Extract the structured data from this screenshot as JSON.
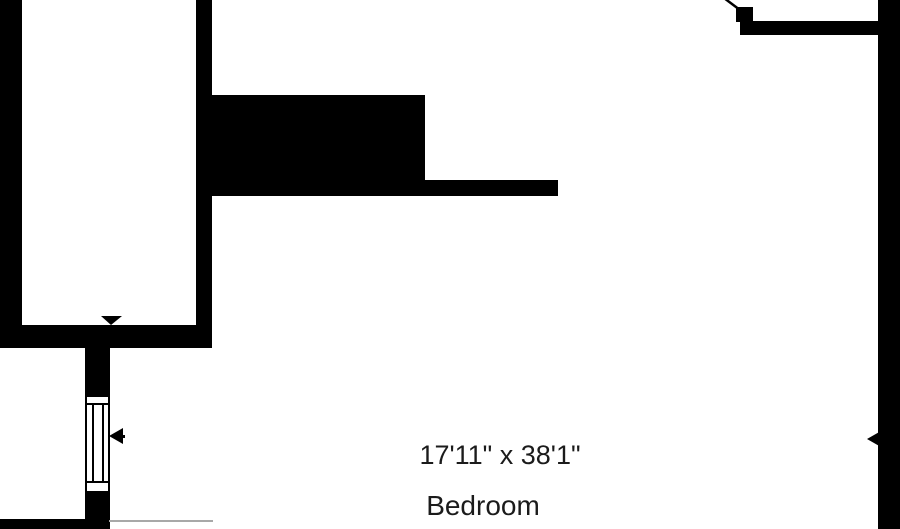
{
  "floorplan": {
    "type": "residential-floor-plan-crop",
    "room": {
      "name": "Bedroom",
      "dimensions": "17'11\" x 38'1\""
    },
    "symbols": {
      "window": "double-hung-window-symbol",
      "door": "door-swing-top-right",
      "arrows": [
        "down-arrow-on-room-bottom-wall",
        "left-arrow-at-window",
        "left-arrow-at-right-wall"
      ]
    },
    "colors": {
      "wall": "#000000",
      "background": "#ffffff",
      "text": "#1b1b1b",
      "break_line": "#a8a8a8"
    }
  }
}
